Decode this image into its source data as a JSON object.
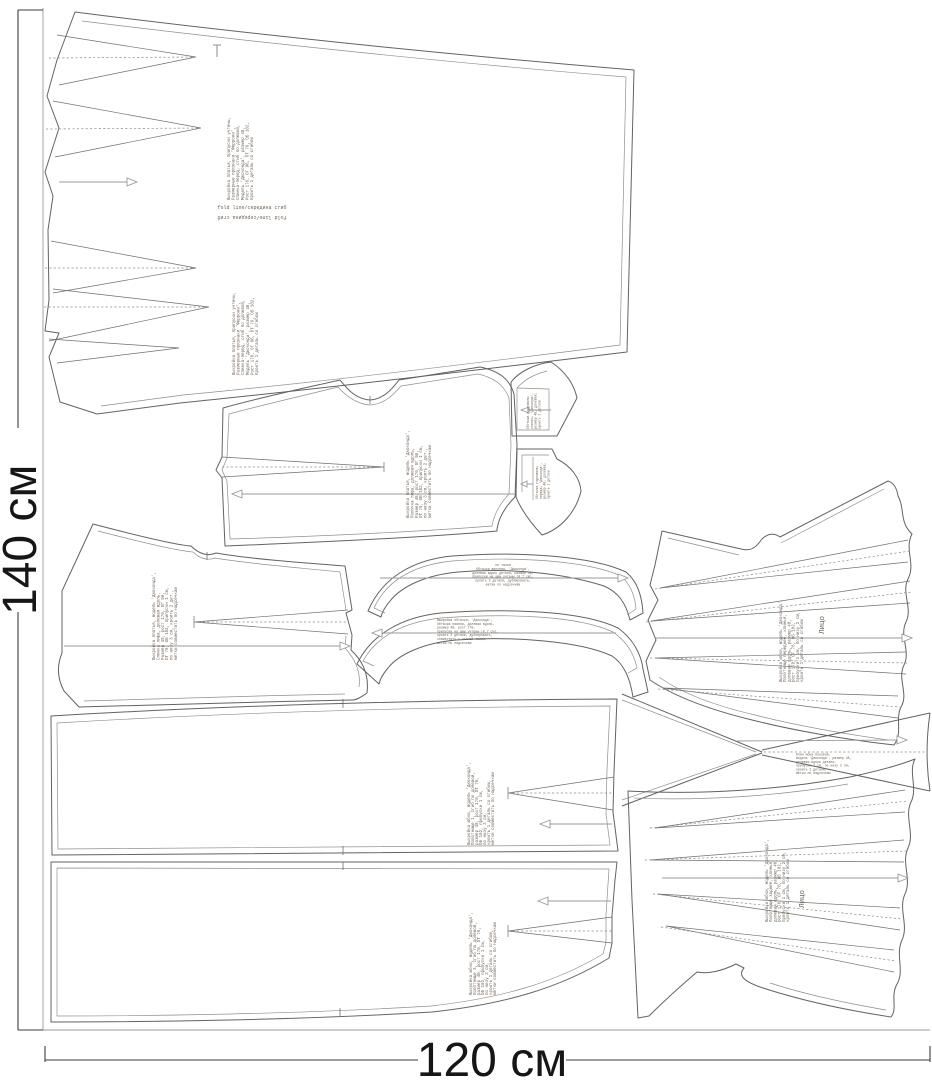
{
  "canvas": {
    "height_label": "140 см",
    "width_label": "120 см"
  },
  "colors": {
    "background": "#ffffff",
    "outline": "#636363",
    "annotation_text": "#6e6258",
    "dimension_text": "#161616"
  },
  "fold_note": {
    "text": "fold line/середина сгиб",
    "mirrored_text": "fold line/середина сгиб"
  },
  "face_label": "Лицо",
  "pieces": {
    "back_dress": {
      "name": "Спинка-перед платья (со сгибом)",
      "lines": [
        "Выкройка платья, припуски учтены,",
        "Размерные признаки 'Феррони',",
        "Спинка-перед, сгиб по долевой,",
        "Модель 'Джоконда', размер 48,",
        "Рост 170, ОГ 96, ОТ 76, ОБ 102,",
        "Кроить 1 деталь со сгибом"
      ]
    },
    "front_bodice": {
      "name": "Полочка лифа",
      "lines": [
        "Выкройка платья, модель 'Джоконда',",
        "Полочка лифа, долевая вдоль,",
        "Размер 48, рост 170, ОГ 96,",
        "ОТ 76, ОБ 102, припуски 1 см,",
        "по низу 3 см, кроить 2 дет.,",
        "метки совместить по надсечкам"
      ]
    },
    "back_bodice": {
      "name": "Спинка лифа",
      "lines": [
        "Выкройка платья, модель 'Джоконда',",
        "Спинка лифа, долевая вдоль,",
        "Размер 48, рост 170, ОГ 96,",
        "ОТ 76, ОБ 102, припуски 1 см,",
        "по низу 3 см, кроить 2 дет.,",
        "метки совместить по надсечкам"
      ]
    },
    "collar_top": {
      "name": "Обтачка горловины спинки",
      "lines": [
        "Обтачка горловины",
        "спинки, 'Джоконда',",
        "размер 48, долевая,",
        "кроить 2 детали"
      ]
    },
    "collar_bottom": {
      "name": "Обтачка горловины переда",
      "lines": [
        "Обтачка горловины",
        "переда, 'Джоконда',",
        "размер 48, долевая,",
        "кроить 2 детали"
      ]
    },
    "facing_upper": {
      "name": "Обтачка верхняя",
      "lines": [
        "по талии",
        "Обтачка верхняя, 'Джоконда',",
        "долевая вдоль детали, размер 48,",
        "припуски на швы учтены (0.7 см),",
        "кроить 2 детали, дублировать,",
        "метки по надсечкам"
      ]
    },
    "facing_lower": {
      "name": "Обтачка нижняя",
      "lines": [
        "Выкройка обтачки, 'Джоконда',",
        "Обтачка нижняя, долевая вдоль,",
        "размер 48, рост 170,",
        "припуски на швы учтены (0.7 см),",
        "кроить 2 детали, дублировать,",
        "совместить с линией талии,",
        "метки по надсечкам"
      ]
    },
    "skirt_front": {
      "name": "Полотнище юбки переднее (клинья)",
      "lines": [
        "Выкройка юбки, модель 'Джоконда',",
        "Полотнище переднее, клинья,",
        "долевая вдоль, размер 48,",
        "рост 170, ОТ 76, ОБ 102,",
        "припуски 1 см, по низу 2 см,",
        "кроить 1 деталь со сгибом"
      ]
    },
    "gusset": {
      "name": "Клин юбки боковой",
      "lines": [
        "Клин юбки боковой,",
        "модель 'Джоконда', размер 48,",
        "долевая вдоль детали,",
        "припуски 1 см, по низу 2 см,",
        "кроить 2 детали,",
        "метки по надсечкам"
      ]
    },
    "skirt_panel_1": {
      "name": "Полотнище юбки 1",
      "lines": [
        "Выкройка юбки, модель 'Джоконда',",
        "Полотнище 1, сгиб по долевой,",
        "размер 48, рост 170, ОТ 76,",
        "ОБ 102, припуски 1 см,",
        "по низу 3 см,",
        "кроить 1 деталь со сгибом,",
        "метки совместить по надсечкам"
      ]
    },
    "skirt_panel_2": {
      "name": "Полотнище юбки 2",
      "lines": [
        "Выкройка юбки, модель 'Джоконда',",
        "Полотнище 2, сгиб по долевой,",
        "размер 48, рост 170, ОТ 76,",
        "ОБ 102, припуски 1 см,",
        "по низу 3 см,",
        "кроить 1 деталь со сгибом,",
        "метки совместить по надсечкам"
      ]
    },
    "skirt_back": {
      "name": "Полотнище юбки заднее (клинья)",
      "lines": [
        "Выкройка юбки, модель 'Джоконда',",
        "Полотнище заднее, клинья,",
        "долевая вдоль, размер 48,",
        "рост 170, ОТ 76, ОБ 102,",
        "припуски 1 см, по низу 2 см,",
        "кроить 1 деталь со сгибом"
      ]
    }
  }
}
